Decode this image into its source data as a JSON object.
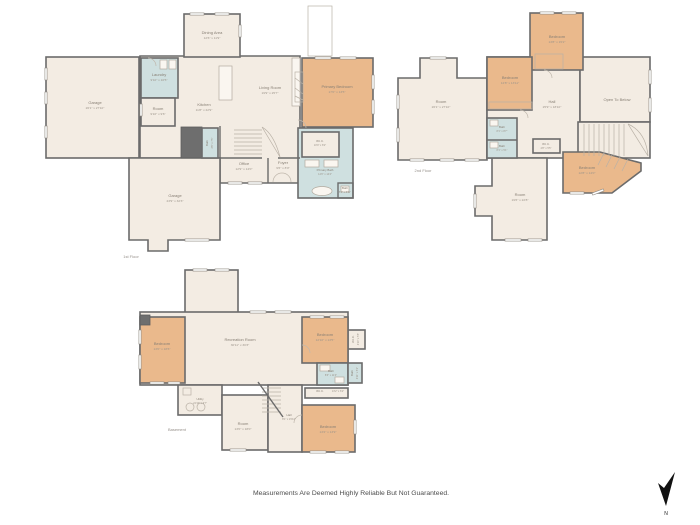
{
  "floors": {
    "first": {
      "label": "1st Floor",
      "rooms": {
        "dining": {
          "name": "Dining Area",
          "dims": "12'6\" x 11'9\""
        },
        "garage_top": {
          "name": "Garage",
          "dims": "26'1\" x 27'10\""
        },
        "laundry": {
          "name": "Laundry",
          "dims": "9'10\" x 10'5\""
        },
        "room_small": {
          "name": "Room",
          "dims": "9'10\" x 9'6\""
        },
        "kitchen": {
          "name": "Kitchen",
          "dims": "11'8\" x 22'9\""
        },
        "living": {
          "name": "Living Room",
          "dims": "19'9\" x 25'7\""
        },
        "primary_bedroom": {
          "name": "Primary Bedroom",
          "dims": "17'0\" x 13'5\""
        },
        "wic": {
          "name": "W.I.C.",
          "dims": "10'9\" x 8'2\""
        },
        "primary_bath": {
          "name": "Primary Bath",
          "dims": "14'0\" x 14'4\""
        },
        "bath_corner": {
          "name": "Bath",
          "dims": "5'6\" x 3'11\""
        },
        "bath_hall": {
          "name": "Bath",
          "dims": "3'6\" x 7'5\""
        },
        "office": {
          "name": "Office",
          "dims": "12'9\" x 14'0\""
        },
        "foyer": {
          "name": "Foyer",
          "dims": "9'6\" x 8'0\""
        },
        "garage_lower": {
          "name": "Garage",
          "dims": "23'9\" x 32'3\""
        }
      }
    },
    "second": {
      "label": "2nd Floor",
      "rooms": {
        "bedroom_top": {
          "name": "Bedroom",
          "dims": "13'8\" x 15'2\""
        },
        "bedroom_left": {
          "name": "Bedroom",
          "dims": "12'8\" x 13'11\""
        },
        "room_big": {
          "name": "Room",
          "dims": "26'1\" x 27'10\""
        },
        "hall": {
          "name": "Hall",
          "dims": "25'9\" x 18'10\""
        },
        "open_below": {
          "name": "Open To Below",
          "dims": ""
        },
        "bath1": {
          "name": "Bath",
          "dims": "8'1\" x 8'7\""
        },
        "bath2": {
          "name": "Bath",
          "dims": "8'1\" x 5'1\""
        },
        "wic": {
          "name": "W.I.C.",
          "dims": "4'8\" x 5'5\""
        },
        "room_bottom": {
          "name": "Room",
          "dims": "19'6\" x 22'8\""
        },
        "bedroom_br": {
          "name": "Bedroom",
          "dims": "12'8\" x 14'0\""
        }
      }
    },
    "basement": {
      "label": "Basement",
      "rooms": {
        "bedroom_left": {
          "name": "Bedroom",
          "dims": "13'0\" x 18'6\""
        },
        "recreation": {
          "name": "Recreation Room",
          "dims": "30'11\" x 30'3\""
        },
        "bedroom_right": {
          "name": "Bedroom",
          "dims": "12'10\" x 13'5\""
        },
        "wic_right": {
          "name": "W.I.C.",
          "dims": "4'10\" x 5'5\""
        },
        "bath_main": {
          "name": "Bath",
          "dims": "8'6\" x 11'4\""
        },
        "bath_small": {
          "name": "Bath",
          "dims": "4'11\" x 5'1\""
        },
        "wic2": {
          "name": "W.I.C.",
          "dims": "13'2\" x 6'2\""
        },
        "utility": {
          "name": "Utility",
          "dims": "24'10\" x 9'7\""
        },
        "room_bottom": {
          "name": "Room",
          "dims": "13'0\" x 18'0\""
        },
        "hall": {
          "name": "Hall",
          "dims": "8'1\" x 15'10\""
        },
        "bedroom_bottom": {
          "name": "Bedroom",
          "dims": "13'2\" x 13'9\""
        }
      }
    }
  },
  "footer": {
    "disclaimer": "Measurements Are Deemed Highly Reliable But Not Guaranteed."
  },
  "compass": {
    "label": "N"
  },
  "palette": {
    "room_fill": "#f3ece3",
    "bedroom_fill": "#eab98c",
    "bath_fill": "#cfe0e0",
    "wall": "#6b6b6b",
    "label_text": "#877f74"
  }
}
